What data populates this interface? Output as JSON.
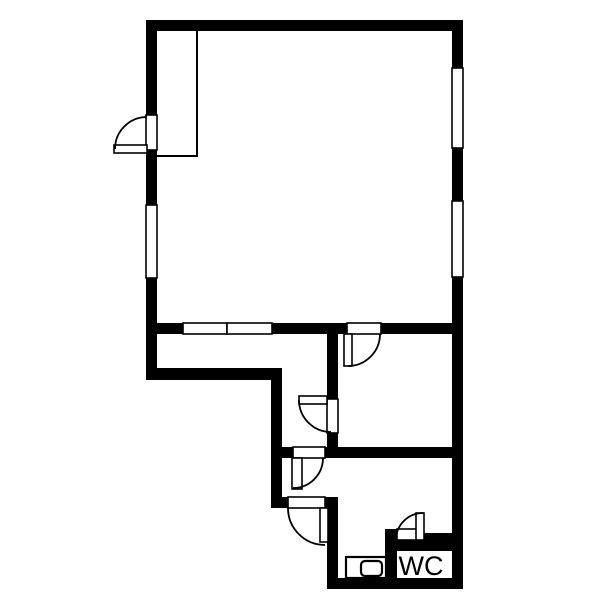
{
  "colors": {
    "wall": "#000000",
    "line": "#000000",
    "background": "#ffffff"
  },
  "floorplan": {
    "canvas": {
      "width": 600,
      "height": 600
    },
    "walls": [
      [
        146,
        20,
        317,
        11
      ],
      [
        146,
        20,
        11,
        360
      ],
      [
        452,
        20,
        11,
        569
      ],
      [
        146,
        323,
        317,
        11
      ],
      [
        146,
        368,
        136,
        12
      ],
      [
        271,
        368,
        11,
        140
      ],
      [
        327,
        323,
        11,
        135
      ],
      [
        271,
        447,
        192,
        11
      ],
      [
        271,
        497,
        67,
        11
      ],
      [
        327,
        497,
        11,
        92
      ],
      [
        327,
        578,
        136,
        11
      ],
      [
        385,
        529,
        12,
        49
      ],
      [
        385,
        540,
        78,
        11
      ],
      [
        423,
        533,
        30,
        8
      ]
    ],
    "windows": [
      [
        146,
        205,
        11,
        73
      ],
      [
        452,
        68,
        11,
        80
      ],
      [
        452,
        201,
        11,
        76
      ],
      [
        183,
        323,
        44,
        11
      ],
      [
        227,
        323,
        45,
        11
      ]
    ],
    "door_openings": [
      [
        146,
        115,
        11,
        35
      ],
      [
        347,
        323,
        34,
        11
      ],
      [
        327,
        399,
        11,
        34
      ],
      [
        293,
        447,
        32,
        11
      ],
      [
        288,
        497,
        37,
        11
      ],
      [
        397,
        529,
        26,
        11
      ]
    ],
    "door_leaves": [
      [
        114,
        145,
        33,
        8
      ],
      [
        344,
        334,
        8,
        32
      ],
      [
        299,
        396,
        28,
        8
      ],
      [
        292,
        458,
        10,
        31
      ],
      [
        320,
        508,
        8,
        34
      ],
      [
        416,
        513,
        8,
        27
      ]
    ],
    "door_arcs": [
      "M115,149 A32,32 0 0 1 147,117",
      "M348,366 A32,32 0 0 0 380,334",
      "M299,400 A32,32 0 0 0 331,432",
      "M323,458 A30,30 0 0 1 293,488",
      "M288,508 A37,37 0 0 0 325,545",
      "M423,513 A27,27 0 0 0 396,540"
    ],
    "closet_outline": "M197,31 L197,156 L157,156",
    "fixture": {
      "outer": [
        346,
        557,
        40,
        21
      ],
      "inner": [
        361,
        561,
        21,
        15
      ],
      "inner_radius": 4
    },
    "labels": [
      {
        "text": "WC",
        "x": 421,
        "y": 575,
        "font_size": 27
      }
    ]
  }
}
